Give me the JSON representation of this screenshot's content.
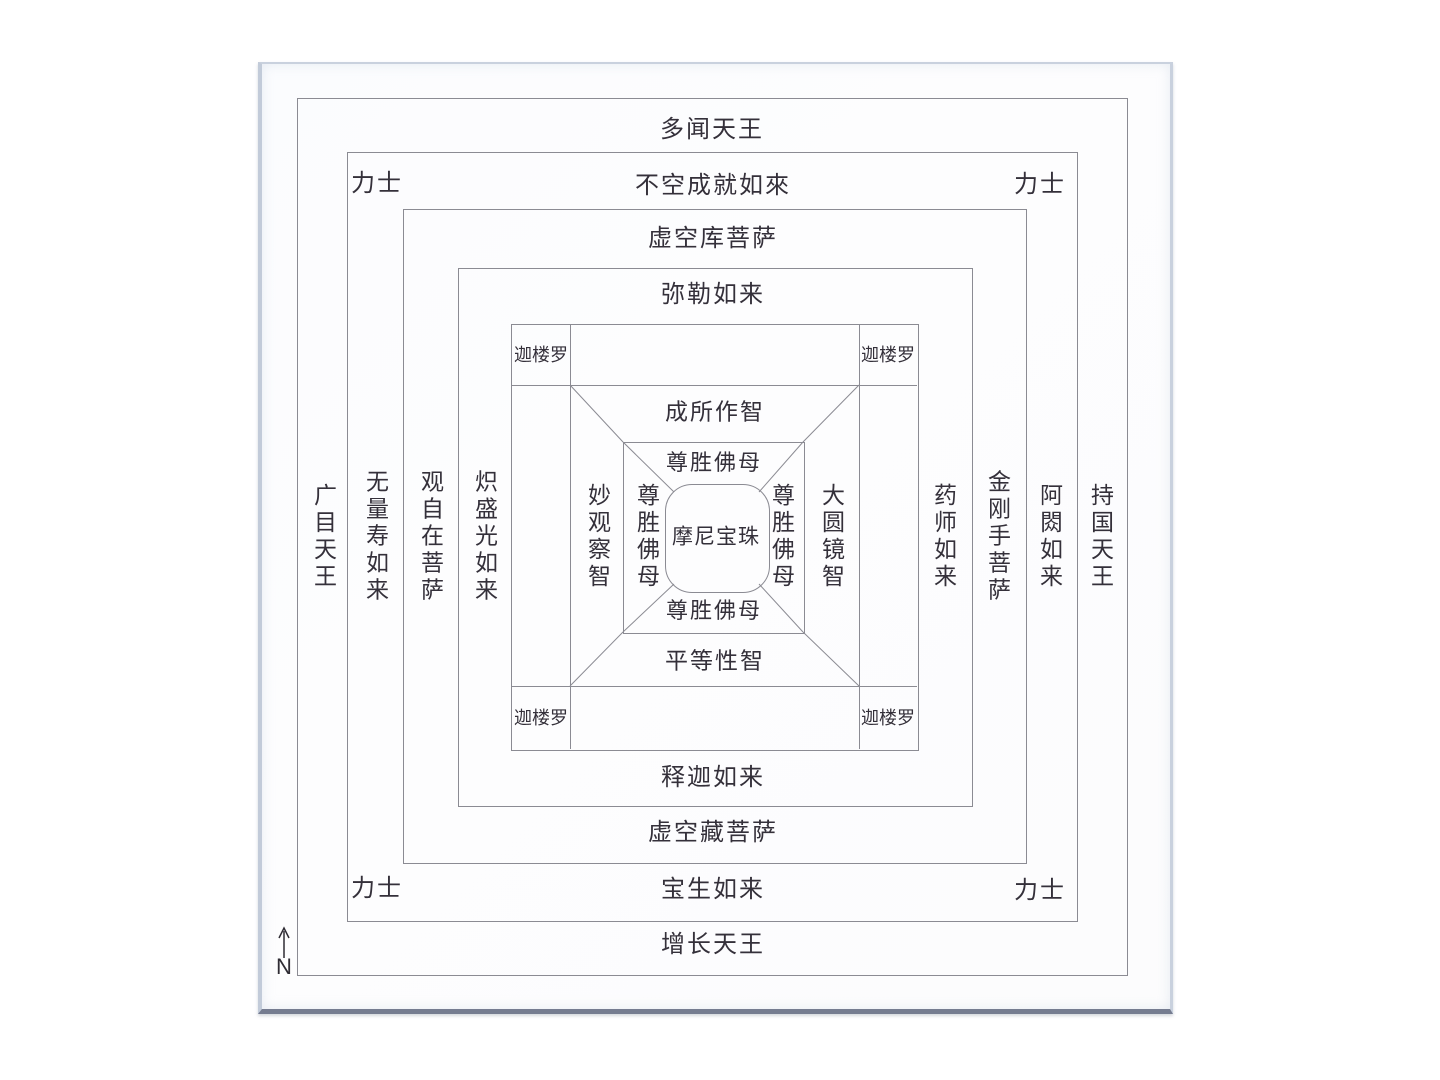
{
  "diagram": {
    "compass": {
      "label": "N"
    },
    "ring1": {
      "top": "多闻天王",
      "bottom": "增长天王",
      "left": "广目天王",
      "right": "持国天王"
    },
    "ring2": {
      "top": "不空成就如來",
      "bottom": "宝生如来",
      "left": "无量寿如来",
      "right": "阿閦如来",
      "guards": [
        "力士",
        "力士",
        "力士",
        "力士"
      ]
    },
    "ring3": {
      "top": "虚空库菩萨",
      "bottom": "虚空藏菩萨",
      "left": "观自在菩萨",
      "right": "金刚手菩萨"
    },
    "ring4": {
      "top": "弥勒如来",
      "bottom": "释迦如来",
      "left": "炽盛光如来",
      "right": "药师如来"
    },
    "ring5": {
      "garudas": [
        "迦楼罗",
        "迦楼罗",
        "迦楼罗",
        "迦楼罗"
      ],
      "wisdom_top": "成所作智",
      "wisdom_bottom": "平等性智",
      "wisdom_left": "妙观察智",
      "wisdom_right": "大圆镜智"
    },
    "ring6": {
      "mother_top": "尊胜佛母",
      "mother_bottom": "尊胜佛母",
      "mother_left": "尊胜佛母",
      "mother_right": "尊胜佛母"
    },
    "center": {
      "jewel": "摩尼宝珠"
    }
  },
  "colors": {
    "line": "#8b8b93",
    "text": "#34303a",
    "paper": "#fdfdfe",
    "photo_edge": "#c2cbd9",
    "photo_edge_bottom": "#757c90"
  }
}
